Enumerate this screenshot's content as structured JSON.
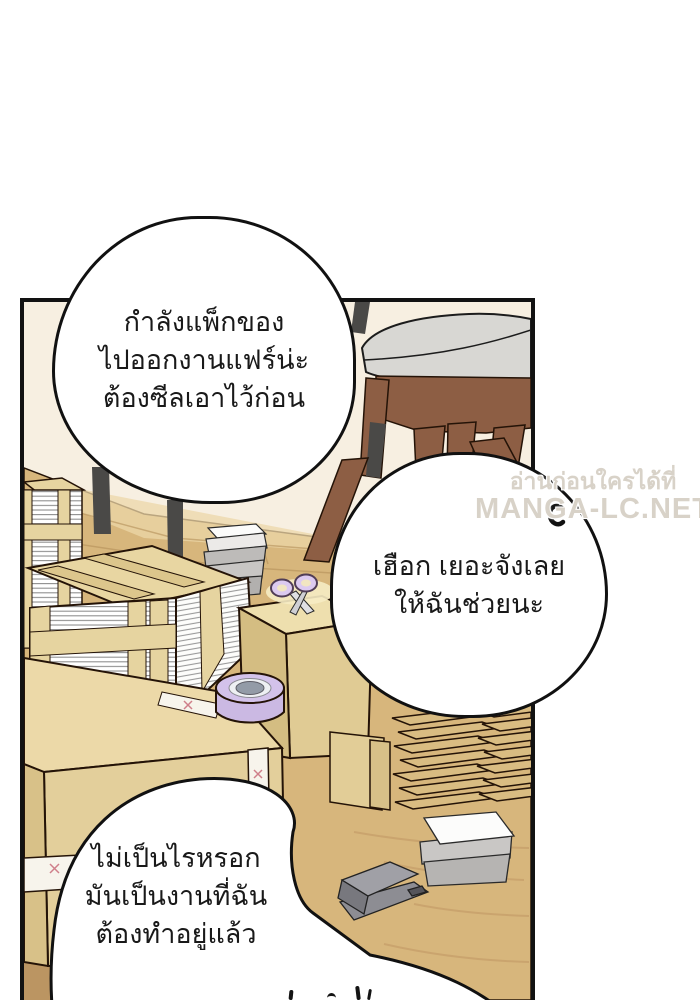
{
  "page": {
    "background": "#ffffff",
    "panel_border_color": "#121212"
  },
  "watermark": {
    "line1": "อ่านก่อนใครได้ที่",
    "line2": "MANGA-LC.NET",
    "color": "#d8d2c8"
  },
  "bubbles": [
    {
      "name": "bubble-packing",
      "lines": [
        "กำลังแพ็กของ",
        "ไปออกงานแฟร์น่ะ",
        "ต้องซีลเอาไว้ก่อน"
      ]
    },
    {
      "name": "bubble-offer-help",
      "lines": [
        "เฮือก เยอะจังเลย",
        "ให้ฉันช่วยนะ"
      ]
    },
    {
      "name": "bubble-decline",
      "lines": [
        "ไม่เป็นไรหรอก",
        "มันเป็นงานที่ฉัน",
        "ต้องทำอยู่แล้ว"
      ]
    }
  ],
  "scene": {
    "objects": [
      "chair",
      "paper-bundle-stack",
      "wooden-crate",
      "cardboard-boxes",
      "packing-tape-roll",
      "scissors",
      "booklet-stacks",
      "flattened-boxes",
      "paper-stack",
      "stapler",
      "wood-floor"
    ],
    "colors": {
      "wall": "#f7efe1",
      "floor": "#d7b67c",
      "floor_dark": "#bb9562",
      "cardboard": "#e3cf9b",
      "cardboard_top": "#ecd9a8",
      "crate_strap": "#e6d4a0",
      "tape_roll": "#cbb9e3",
      "scissors_handle": "#dccaf0",
      "chair_seat": "#d8d7d3",
      "chair_wood": "#8d5e44",
      "chair_metal": "#4a4947",
      "tape_strip": "#f7f4ec",
      "tape_mark_pink": "#cf7f8a",
      "outline": "#241307"
    }
  }
}
